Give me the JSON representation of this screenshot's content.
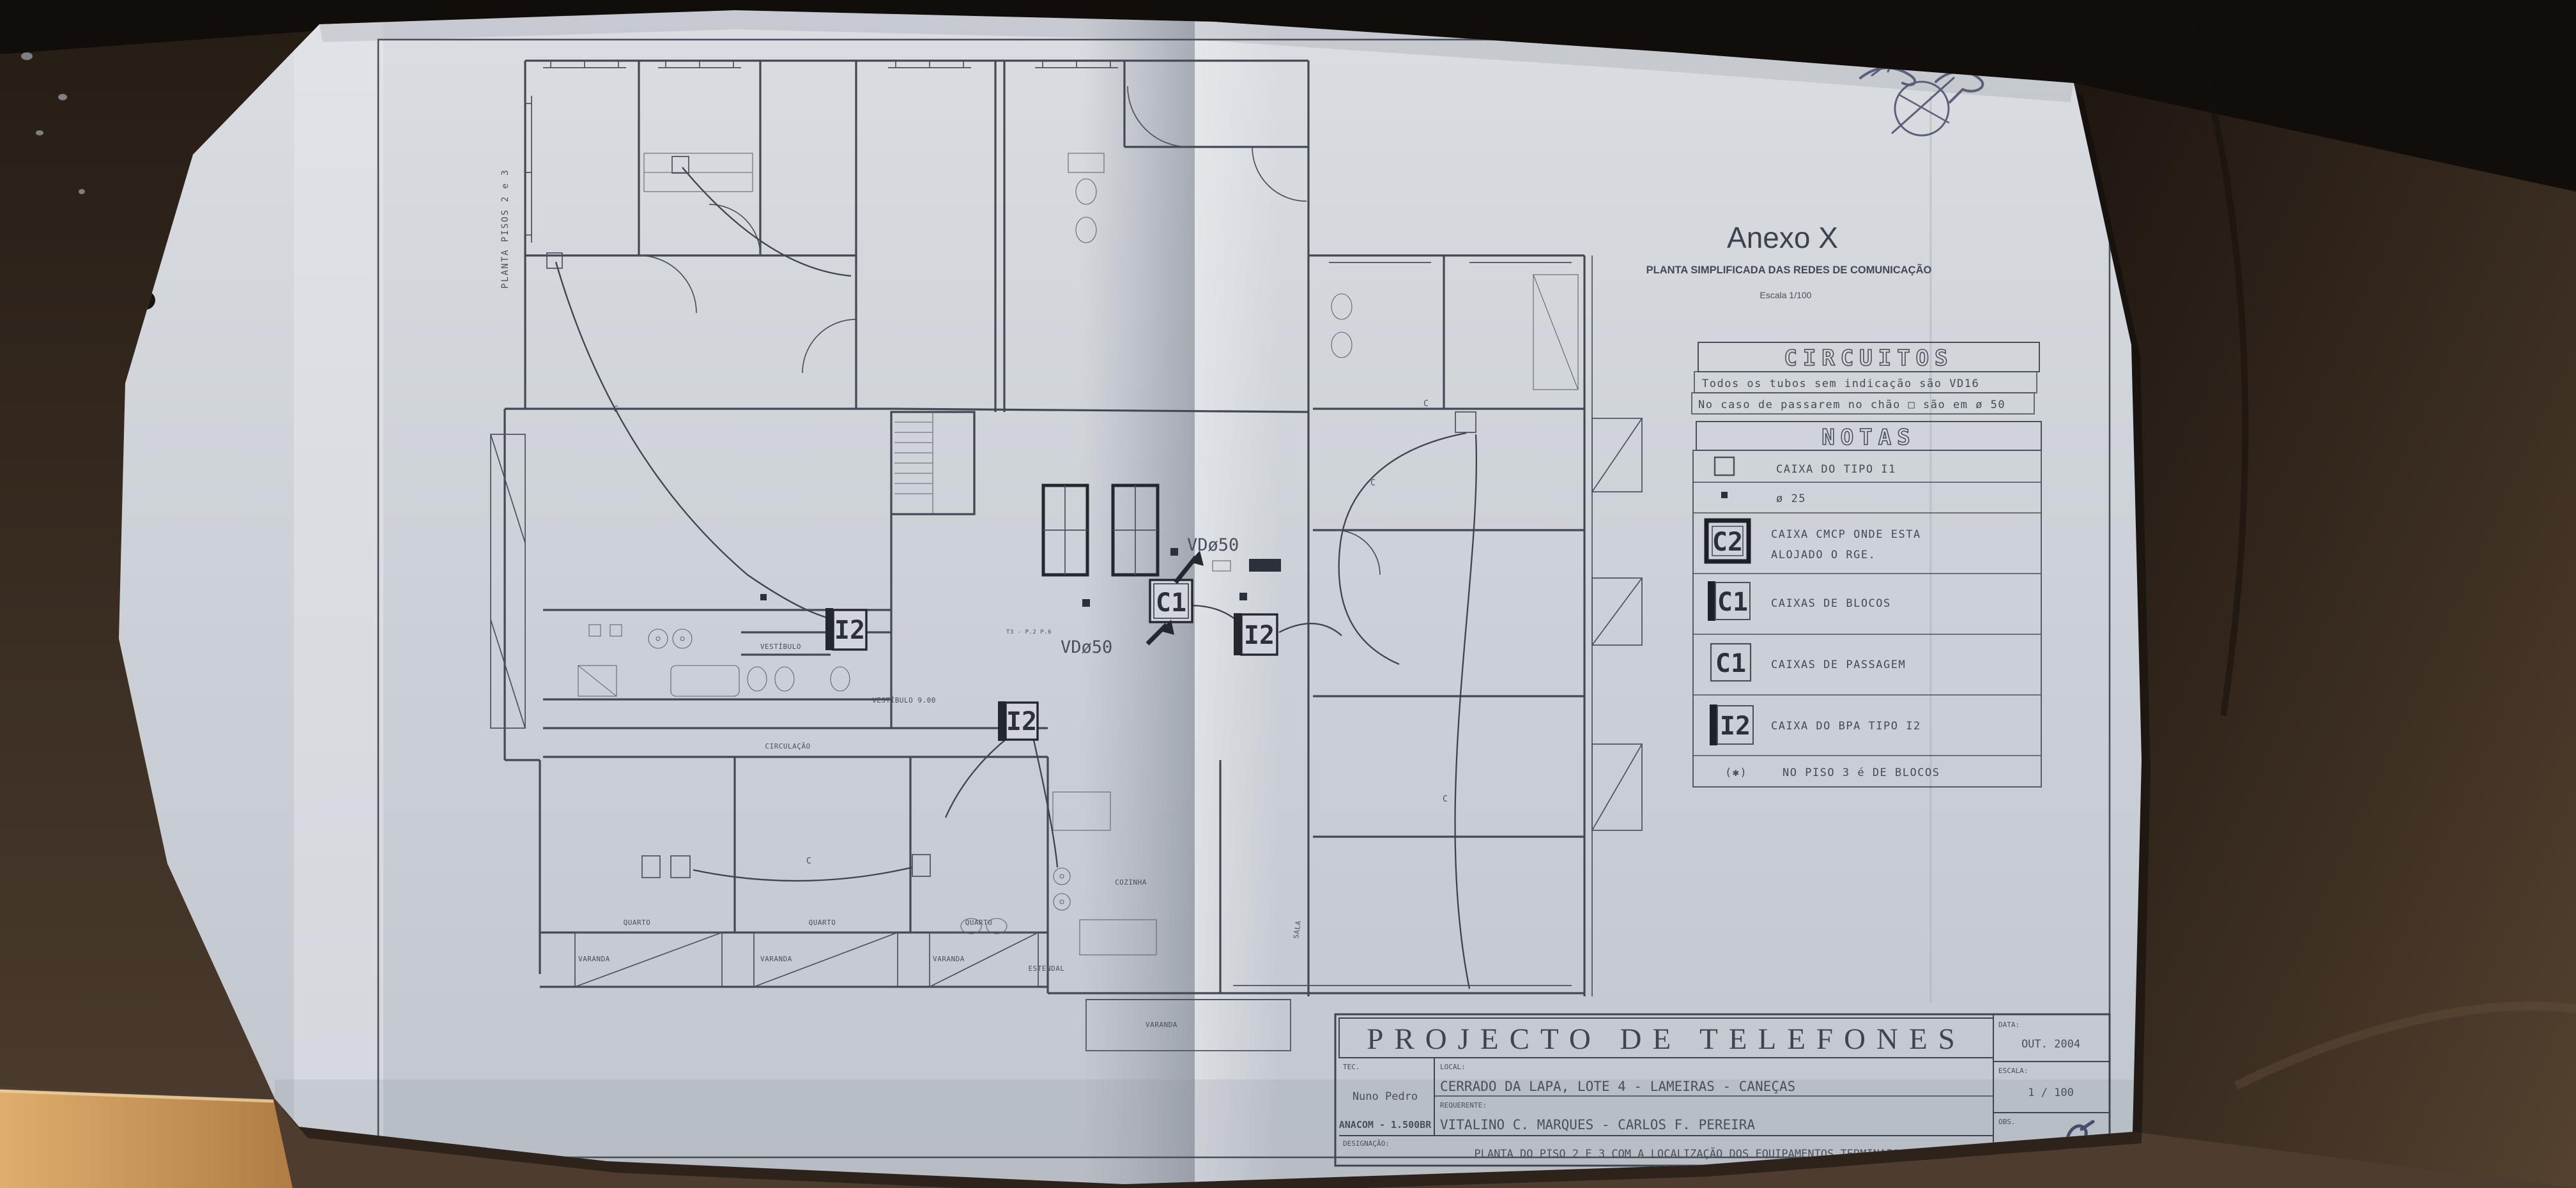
{
  "annex": {
    "title": "Anexo X",
    "subtitle": "PLANTA SIMPLIFICADA DAS REDES DE COMUNICAÇÃO",
    "scale_note": "Escala 1/100"
  },
  "circuits": {
    "title": "CIRCUITOS",
    "line1": "Todos os tubos sem indicação são VD16",
    "line2": "No caso de passarem no chão □ são em ø 50"
  },
  "notes": {
    "title": "NOTAS",
    "items": [
      {
        "sym": "",
        "label": "CAIXA DO TIPO I1"
      },
      {
        "sym": "",
        "label": "ø 25"
      },
      {
        "sym": "C2",
        "label": "CAIXA CMCP ONDE ESTA",
        "label2": "ALOJADO O RGE."
      },
      {
        "sym": "C1",
        "label": "CAIXAS DE BLOCOS"
      },
      {
        "sym": "C1",
        "label": "CAIXAS DE PASSAGEM"
      },
      {
        "sym": "I2",
        "label": "CAIXA DO BPA TIPO I2"
      }
    ],
    "footnote_sym": "(✱)",
    "footnote": "NO PISO 3 é DE BLOCOS"
  },
  "titleblock": {
    "title": "PROJECTO DE TELEFONES",
    "tec_label": "TEC.",
    "tec_name": "Nuno Pedro",
    "tec_id": "ANACOM - 1.500BR",
    "local_label": "LOCAL:",
    "local_value": "CERRADO DA LAPA, LOTE 4 - LAMEIRAS - CANEÇAS",
    "req_label": "REQUERENTE:",
    "req_value": "VITALINO C. MARQUES - CARLOS F. PEREIRA",
    "desig_label": "DESIGNAÇÃO:",
    "desig_value": "PLANTA DO PISO 2 E 3 COM A LOCALIZAÇÃO DOS EQUIPAMENTOS TERMINAIS",
    "data_label": "DATA:",
    "data_value": "OUT. 2004",
    "escala_label": "ESCALA:",
    "escala_value": "1 / 100",
    "obs_label": "OBS.",
    "obs_value": "TEL. 03"
  },
  "plan": {
    "side_label": "PLANTA PISOS 2 e 3",
    "markers": {
      "i2": "I2",
      "c1": "C1"
    },
    "vd50": "VDø50",
    "cable_c": "C",
    "t3_note": "T3 - P.2 P.6",
    "rooms": {
      "quarto": "QUARTO",
      "varanda": "VARANDA",
      "cozinha": "COZINHA",
      "circulacao": "CIRCULAÇÃO",
      "vestibulo": "VESTÍBULO",
      "vestibulo_dim": "VESTÍBULO 9.00",
      "estendal": "ESTENDAL",
      "sala": "SALA"
    },
    "colors": {
      "paper": "#ccd1d7",
      "ink": "#4b515b",
      "leather_dark": "#100d0a",
      "leather": "#3a2e24",
      "tan": "#d9a765"
    }
  }
}
